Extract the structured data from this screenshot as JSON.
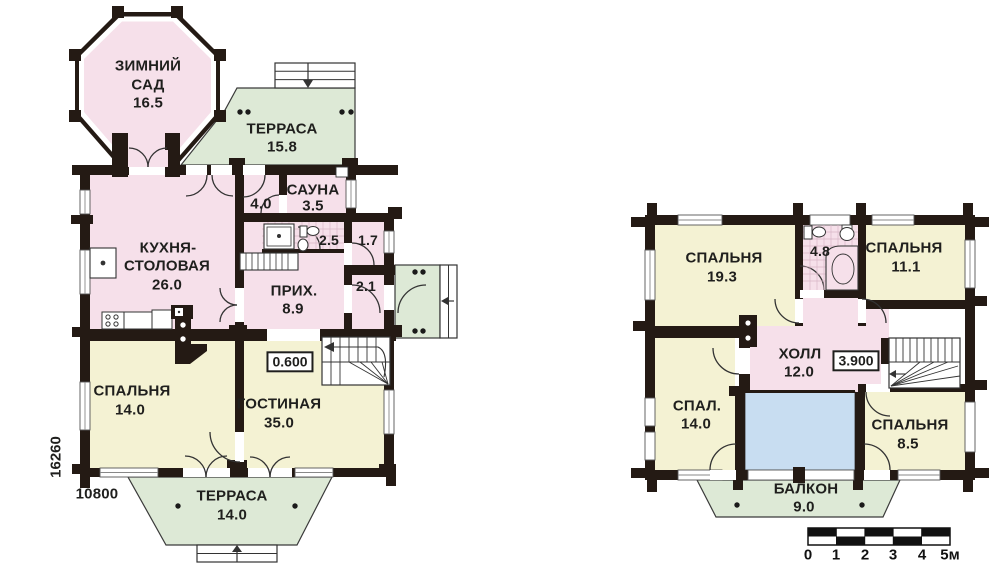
{
  "document": {
    "kind": "house floor plan drawing",
    "floors": 2
  },
  "colors": {
    "room_pink": "#f6e0ea",
    "room_yellow": "#f4f2d3",
    "terrace_green": "#dde9d6",
    "void_blue": "#c8ddf1",
    "wall_dark": "#241a14"
  },
  "floor1": {
    "winter_garden": {
      "l1": "ЗИМНИЙ",
      "l2": "САД",
      "area": "16.5"
    },
    "terrace_top": {
      "name": "ТЕРРАСА",
      "area": "15.8"
    },
    "room_40": {
      "area": "4.0"
    },
    "sauna": {
      "name": "САУНА",
      "area": "3.5"
    },
    "wc": {
      "area": "2.5"
    },
    "closet": {
      "area": "1.7"
    },
    "entry": {
      "area": "2.1"
    },
    "kitchen": {
      "l1": "КУХНЯ-",
      "l2": "СТОЛОВАЯ",
      "area": "26.0"
    },
    "hallway": {
      "name": "ПРИХ.",
      "area": "8.9"
    },
    "bedroom": {
      "name": "СПАЛЬНЯ",
      "area": "14.0"
    },
    "living": {
      "name": "ГОСТИНАЯ",
      "area": "35.0"
    },
    "terrace_bottom": {
      "name": "ТЕРРАСА",
      "area": "14.0"
    },
    "elevation": "0.600",
    "dim_height": "16260",
    "dim_width": "10800"
  },
  "floor2": {
    "bedroom1": {
      "name": "СПАЛЬНЯ",
      "area": "19.3"
    },
    "bath": {
      "area": "4.8"
    },
    "bedroom2": {
      "name": "СПАЛЬНЯ",
      "area": "11.1"
    },
    "hall": {
      "name": "ХОЛЛ",
      "area": "12.0"
    },
    "bedroom3": {
      "name": "СПАЛ.",
      "area": "14.0"
    },
    "bedroom4": {
      "name": "СПАЛЬНЯ",
      "area": "8.5"
    },
    "balcony": {
      "name": "БАЛКОН",
      "area": "9.0"
    },
    "elevation": "3.900"
  },
  "scale_bar": {
    "ticks": [
      "0",
      "1",
      "2",
      "3",
      "4",
      "5м"
    ]
  }
}
